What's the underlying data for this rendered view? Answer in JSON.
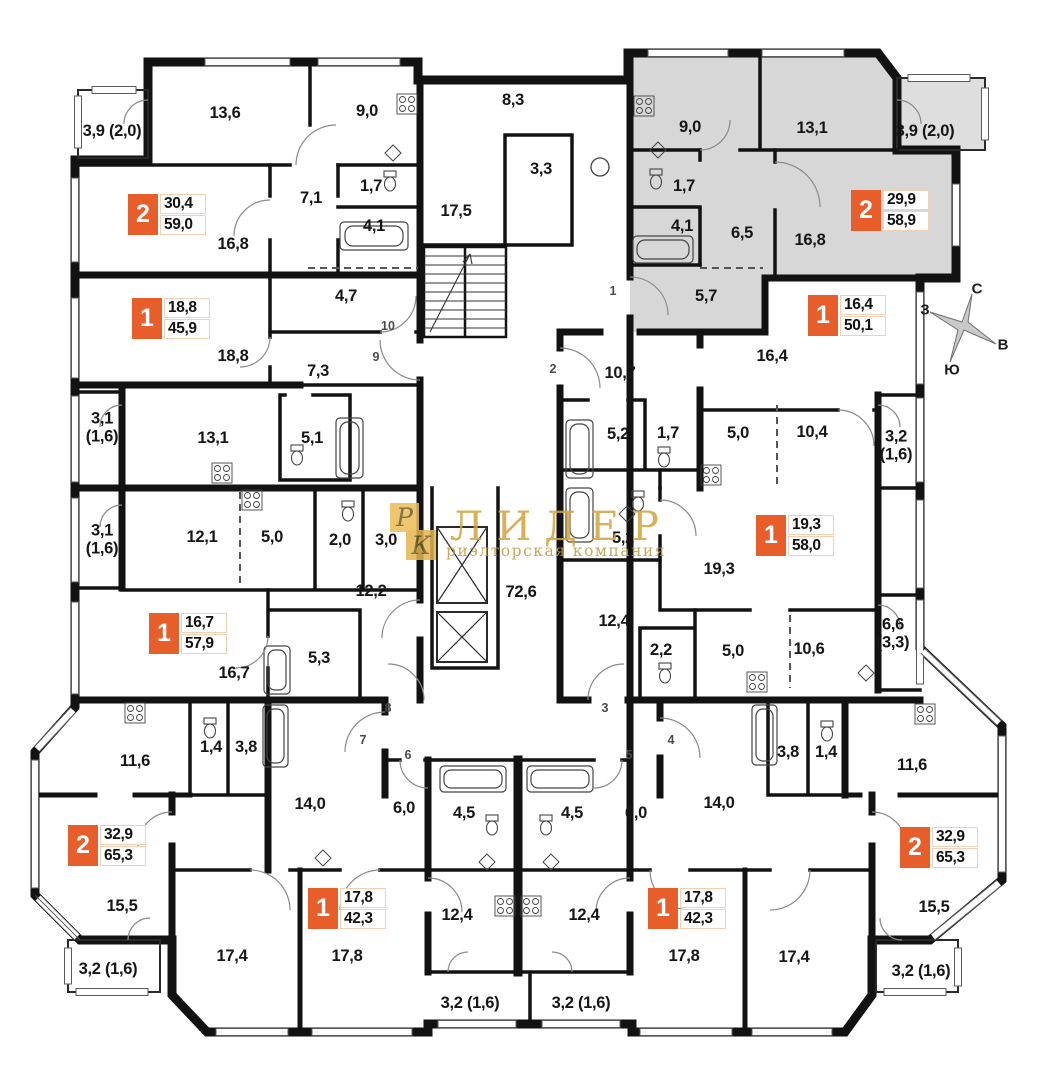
{
  "colors": {
    "badge_orange": "#E85E2B",
    "highlight_gray": "#D7D7D7",
    "watermark_gold": "#D2A33C",
    "wall": "#121212"
  },
  "watermark": {
    "logo_letter_top": "Р",
    "logo_letter_bottom": "К",
    "title": "ЛИДЕР",
    "subtitle": "риэлторская компания"
  },
  "compass": {
    "north": "С",
    "east": "В",
    "south": "Ю",
    "west": "З"
  },
  "rooms": [
    {
      "label": "13,6"
    },
    {
      "label": "9,0"
    },
    {
      "label": "3,9 (2,0)"
    },
    {
      "label": "8,3"
    },
    {
      "label": "7,1"
    },
    {
      "label": "1,7"
    },
    {
      "label": "4,1"
    },
    {
      "label": "17,5"
    },
    {
      "label": "3,3"
    },
    {
      "label": "16,8"
    },
    {
      "label": "4,7"
    },
    {
      "label": "18,8"
    },
    {
      "label": "7,3"
    },
    {
      "label": "9,0"
    },
    {
      "label": "13,1"
    },
    {
      "label": "3,9 (2,0)"
    },
    {
      "label": "1,7"
    },
    {
      "label": "4,1"
    },
    {
      "label": "6,5"
    },
    {
      "label": "16,8"
    },
    {
      "label": "5,7"
    },
    {
      "label": "16,4"
    },
    {
      "label": "10,7"
    },
    {
      "label": "3,1 (1,6)"
    },
    {
      "label": "13,1"
    },
    {
      "label": "5,1"
    },
    {
      "label": "5,2"
    },
    {
      "label": "1,7"
    },
    {
      "label": "5,0"
    },
    {
      "label": "10,4"
    },
    {
      "label": "3,2 (1,6)"
    },
    {
      "label": "3,1 (1,6)"
    },
    {
      "label": "12,1"
    },
    {
      "label": "5,0"
    },
    {
      "label": "2,0"
    },
    {
      "label": "3,0"
    },
    {
      "label": "5,2"
    },
    {
      "label": "12,2"
    },
    {
      "label": "19,3"
    },
    {
      "label": "72,6"
    },
    {
      "label": "16,7"
    },
    {
      "label": "5,3"
    },
    {
      "label": "12,4"
    },
    {
      "label": "2,2"
    },
    {
      "label": "5,0"
    },
    {
      "label": "10,6"
    },
    {
      "label": "6,6 (3,3)"
    },
    {
      "label": "11,6"
    },
    {
      "label": "1,4"
    },
    {
      "label": "3,8"
    },
    {
      "label": "14,0"
    },
    {
      "label": "6,0"
    },
    {
      "label": "4,5"
    },
    {
      "label": "4,5"
    },
    {
      "label": "6,0"
    },
    {
      "label": "14,0"
    },
    {
      "label": "3,8"
    },
    {
      "label": "1,4"
    },
    {
      "label": "11,6"
    },
    {
      "label": "15,5"
    },
    {
      "label": "15,5"
    },
    {
      "label": "17,4"
    },
    {
      "label": "17,8"
    },
    {
      "label": "12,4"
    },
    {
      "label": "12,4"
    },
    {
      "label": "17,8"
    },
    {
      "label": "17,4"
    },
    {
      "label": "3,2 (1,6)"
    },
    {
      "label": "3,2 (1,6)"
    },
    {
      "label": "3,2 (1,6)"
    },
    {
      "label": "3,2 (1,6)"
    }
  ],
  "entrances": [
    {
      "number": "1"
    },
    {
      "number": "2"
    },
    {
      "number": "3"
    },
    {
      "number": "4"
    },
    {
      "number": "5"
    },
    {
      "number": "6"
    },
    {
      "number": "7"
    },
    {
      "number": "8"
    },
    {
      "number": "9"
    },
    {
      "number": "10"
    }
  ],
  "units": [
    {
      "rooms": "2",
      "living": "30,4",
      "total": "59,0"
    },
    {
      "rooms": "1",
      "living": "18,8",
      "total": "45,9"
    },
    {
      "rooms": "2",
      "living": "29,9",
      "total": "58,9"
    },
    {
      "rooms": "1",
      "living": "16,4",
      "total": "50,1"
    },
    {
      "rooms": "1",
      "living": "16,7",
      "total": "57,9"
    },
    {
      "rooms": "1",
      "living": "19,3",
      "total": "58,0"
    },
    {
      "rooms": "2",
      "living": "32,9",
      "total": "65,3"
    },
    {
      "rooms": "1",
      "living": "17,8",
      "total": "42,3"
    },
    {
      "rooms": "1",
      "living": "17,8",
      "total": "42,3"
    },
    {
      "rooms": "2",
      "living": "32,9",
      "total": "65,3"
    }
  ]
}
